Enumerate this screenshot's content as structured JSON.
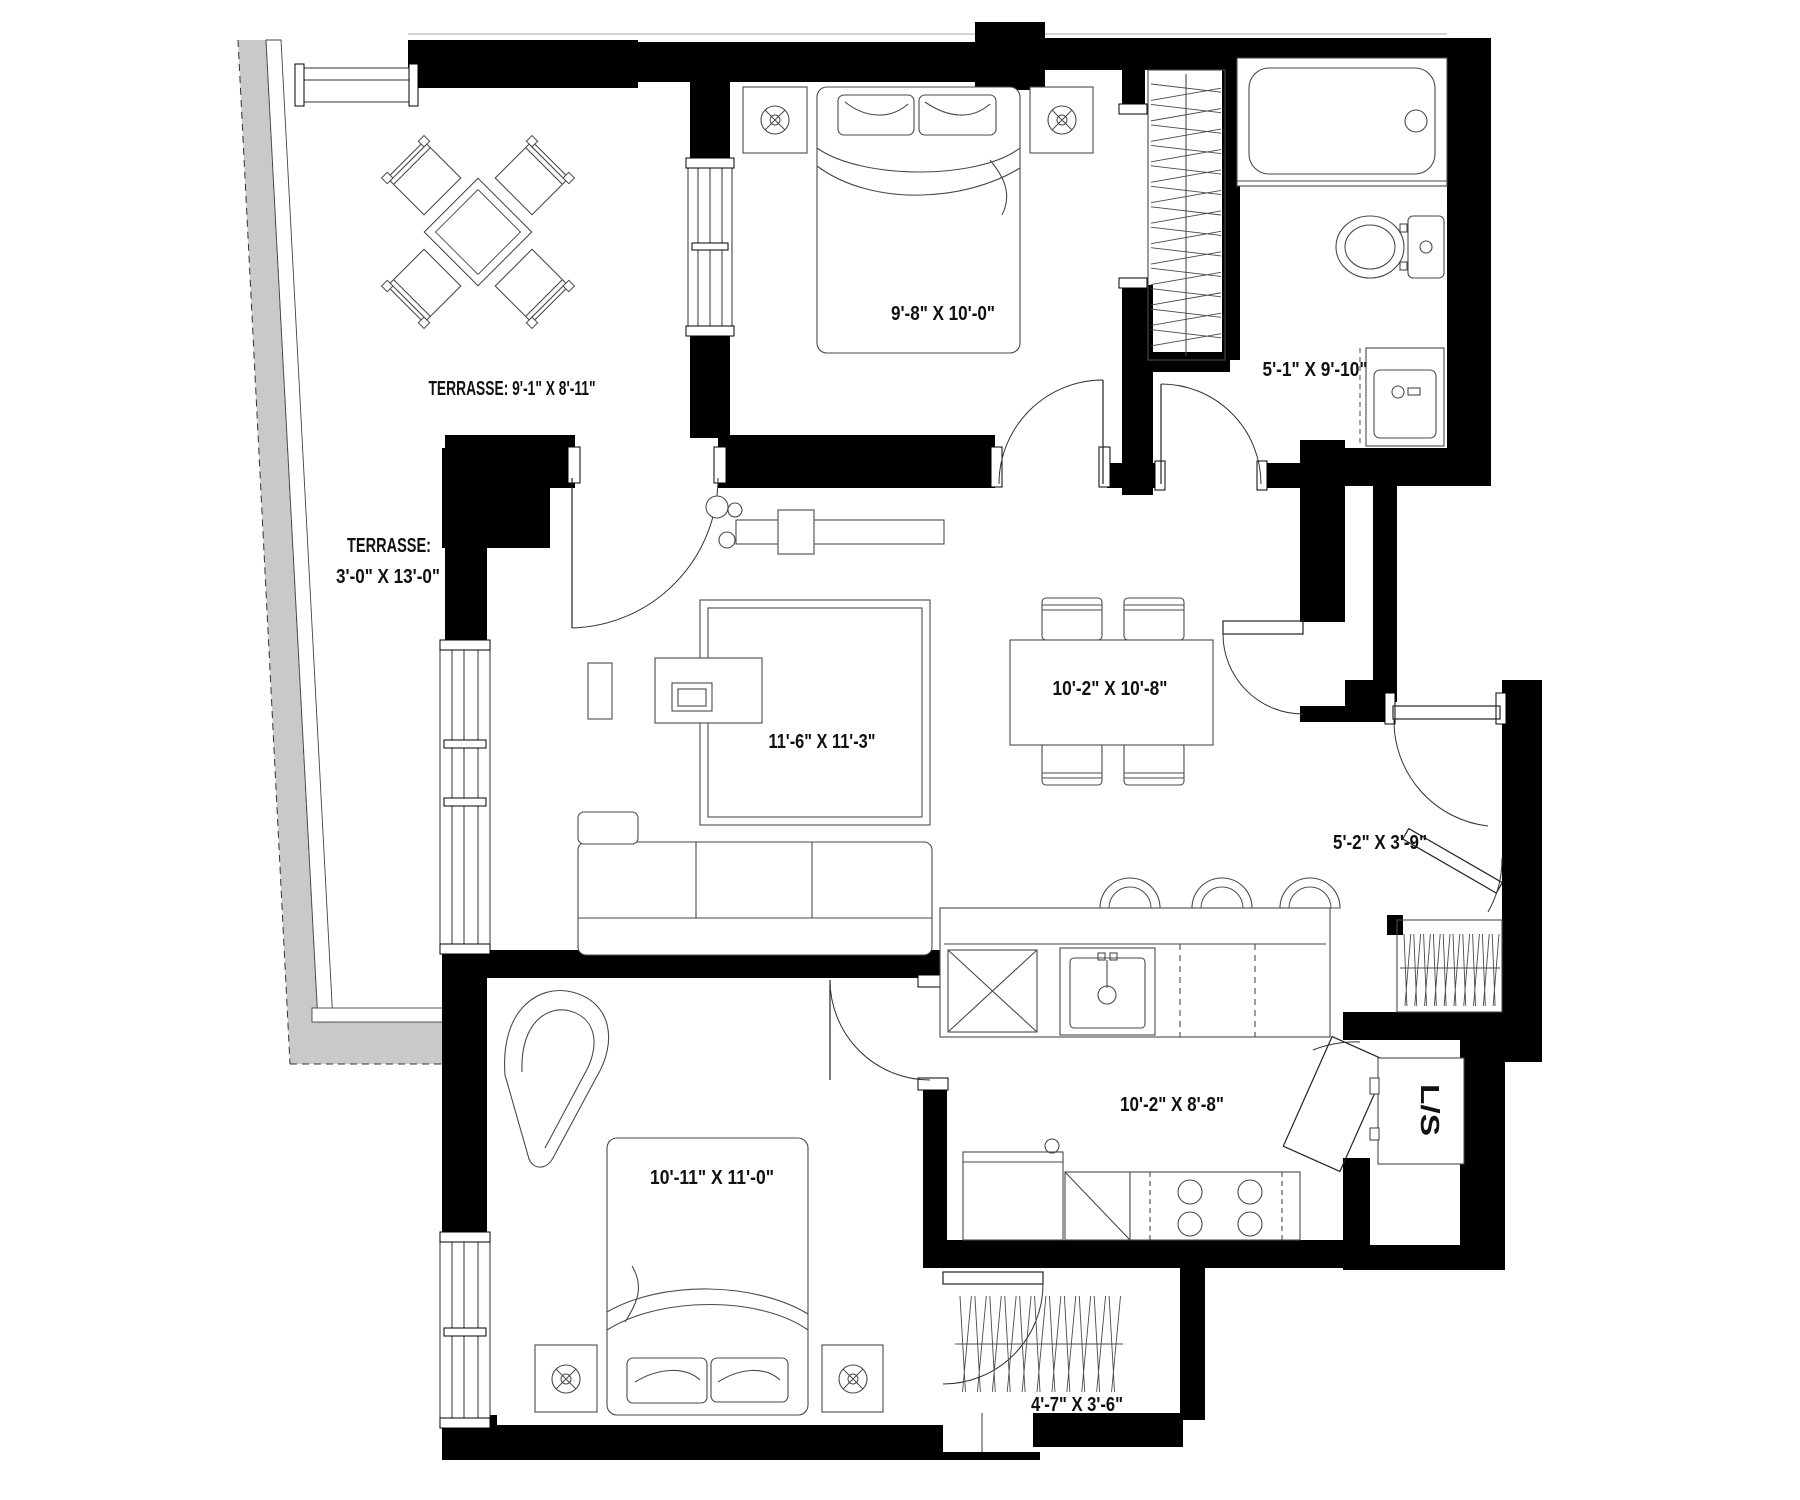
{
  "document": {
    "type": "residential floor plan",
    "units": "feet-inches"
  },
  "palette": {
    "wall": "#000000",
    "furniture_line": "#4a4a4a",
    "terrace_band": "#c9c9c9",
    "text": "#111111",
    "background": "#ffffff"
  },
  "labels": {
    "terrace_main": "TERRASSE: 9'-1\" X 8'-11\"",
    "terrace_side_line1": "TERRASSE:",
    "terrace_side_line2": "3'-0\" X 13'-0\"",
    "bedroom_primary": "9'-8\" X 10'-0\"",
    "bathroom": "5'-1\" X 9'-10\"",
    "dining": "10'-2\" X 10'-8\"",
    "living": "11'-6\" X 11'-3\"",
    "entry": "5'-2\" X 3'-9\"",
    "kitchen": "10'-2\" X 8'-8\"",
    "bedroom_second": "10'-11\" X 11'-0\"",
    "closet_bedroom_second": "4'-7\" X 3'-6\"",
    "laundry_storage": "L/S"
  }
}
